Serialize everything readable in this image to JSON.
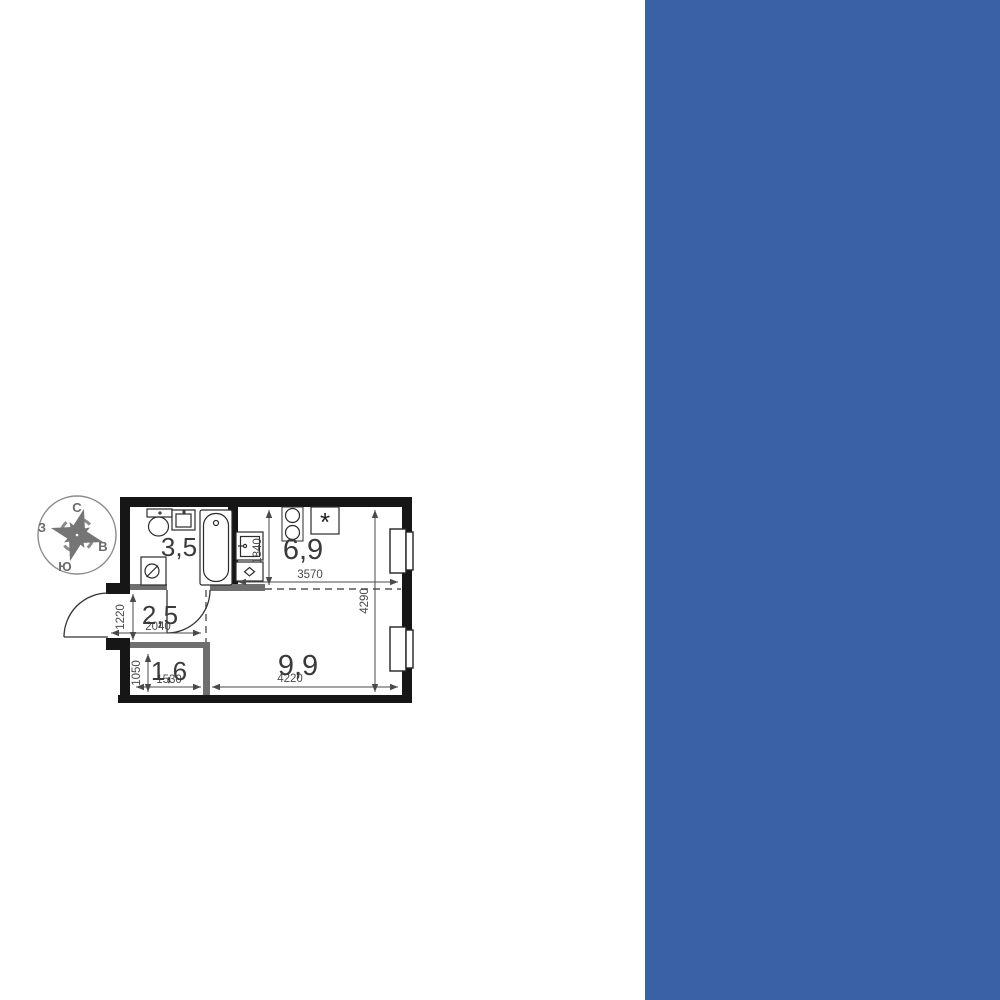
{
  "card": {
    "panel_color": "#3a60a6",
    "brand": {
      "logo_number": "1",
      "logo_letters": "ДСК",
      "complex_name": "1-й ЯСЕНЕВСКИЙ"
    },
    "sections": {
      "area": {
        "title": "Площадь",
        "value": "24 м",
        "sup": "2"
      },
      "finish": {
        "title": "Отделка",
        "value": "Чистовая"
      },
      "deadline": {
        "title": "Срок сдачи",
        "line1": "I квартал,",
        "line2": "2028"
      }
    }
  },
  "floorplan": {
    "compass": {
      "n": "С",
      "e": "В",
      "s": "Ю",
      "w": "З"
    },
    "rooms": {
      "bathroom": "3,5",
      "kitchen": "6,9",
      "hall": "2,5",
      "storage": "1,6",
      "living": "9,9"
    },
    "dims": {
      "kitchen_depth": "1840",
      "kitchen_width": "3570",
      "right_side": "4290",
      "hall_left": "1220",
      "hall_width": "2040",
      "storage_left": "1050",
      "storage_width": "1530",
      "living_width": "4220"
    },
    "kitchen_star": "*"
  }
}
